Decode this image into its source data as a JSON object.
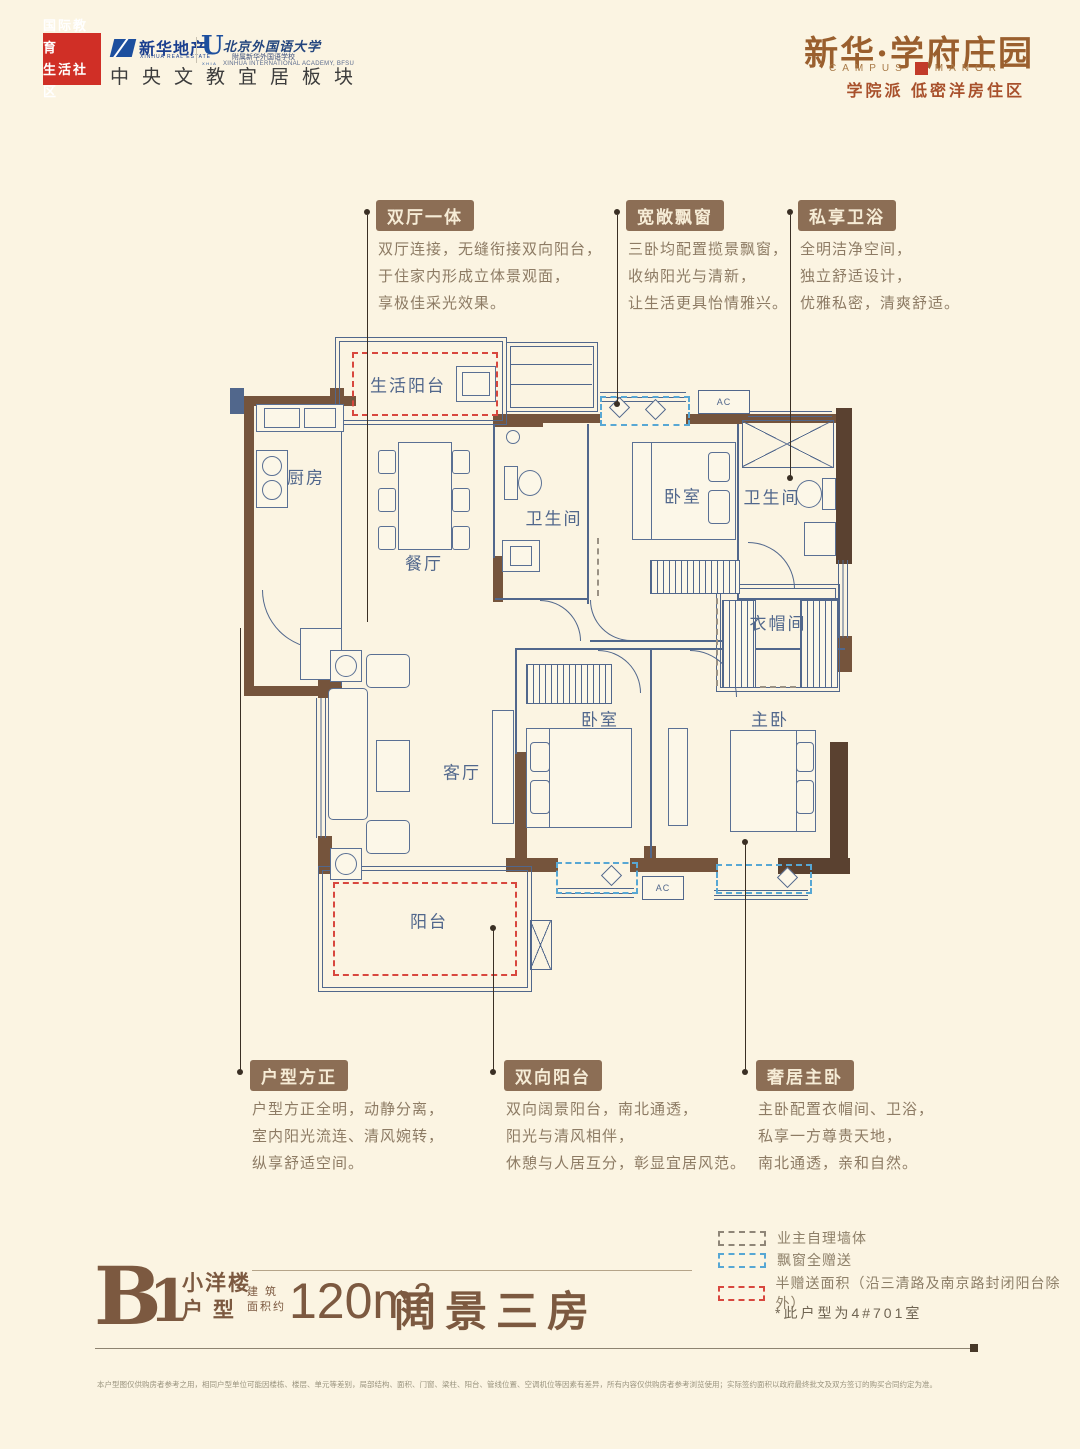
{
  "header": {
    "community_badge": {
      "line1": "国际教育",
      "line2": "生活社区"
    },
    "developer": {
      "name": "新华地产",
      "sub": "XINHUA REAL ESTATE"
    },
    "academy": {
      "initial": "U",
      "initial_sub": "XHIA",
      "name": "北京外国语大学",
      "affiliate": "附属新华外国语学校",
      "en": "XINHUA INTERNATIONAL ACADEMY, BFSU"
    },
    "tagline": "中央文教宜居板块",
    "brand": {
      "title": "新华·学府庄园",
      "en_left": "CAMPUS",
      "en_right": "MANOR",
      "subtitle": "学院派 低密洋房住区"
    }
  },
  "plan": {
    "rooms": {
      "living_balcony": "生活阳台",
      "kitchen": "厨房",
      "dining": "餐厅",
      "bath1": "卫生间",
      "bedroom1": "卧室",
      "bath2": "卫生间",
      "cloakroom": "衣帽间",
      "living": "客厅",
      "bedroom2": "卧室",
      "master": "主卧",
      "balcony": "阳台"
    },
    "ac_label": "AC"
  },
  "callouts": [
    {
      "label": "双厅一体",
      "lines": [
        "双厅连接，无缝衔接双向阳台，",
        "于住家内形成立体景观面，",
        "享极佳采光效果。"
      ]
    },
    {
      "label": "宽敞飘窗",
      "lines": [
        "三卧均配置揽景飘窗，",
        "收纳阳光与清新，",
        "让生活更具怡情雅兴。"
      ]
    },
    {
      "label": "私享卫浴",
      "lines": [
        "全明洁净空间，",
        "独立舒适设计，",
        "优雅私密，清爽舒适。"
      ]
    },
    {
      "label": "户型方正",
      "lines": [
        "户型方正全明，动静分离，",
        "室内阳光流连、清风婉转，",
        "纵享舒适空间。"
      ]
    },
    {
      "label": "双向阳台",
      "lines": [
        "双向阔景阳台，南北通透，",
        "阳光与清风相伴，",
        "休憩与人居互分，彰显宜居风范。"
      ]
    },
    {
      "label": "奢居主卧",
      "lines": [
        "主卧配置衣帽间、卫浴，",
        "私享一方尊贵天地，",
        "南北通透，亲和自然。"
      ]
    }
  ],
  "unit": {
    "code": "B",
    "number": "1",
    "type_line1": "小洋楼",
    "type_line2": "户 型",
    "area_label_line1": "建 筑",
    "area_label_line2": "面积约",
    "area": "120m²",
    "name": "阔景三房"
  },
  "legend": {
    "items": [
      {
        "label": "业主自理墙体",
        "color": "#8f8678"
      },
      {
        "label": "飘窗全赠送",
        "color": "#57a7d4"
      },
      {
        "label": "半赠送面积（沿三清路及南京路封闭阳台除外）",
        "color": "#d8473e"
      }
    ],
    "note": "*此户型为4#701室"
  },
  "disclaimer": "本户型图仅供购房者参考之用，相同户型单位可能因楼栋、楼层、单元等差别，局部结构、面积、门窗、梁柱、阳台、管线位置、空调机位等因素有差异，所有内容仅供购房者参考浏览使用；实际签约面积以政府最终批文及双方签订的购买合同约定为准。",
  "colors": {
    "background": "#fbf4e2",
    "wall": "#75543c",
    "plan_line": "#51678c",
    "brand": "#9a5f2e",
    "accent_red": "#d02f26",
    "callout_badge": "#8c6e55",
    "dashed_red": "#d8473e",
    "dashed_blue": "#57a7d4",
    "dashed_gray": "#9a9184"
  }
}
